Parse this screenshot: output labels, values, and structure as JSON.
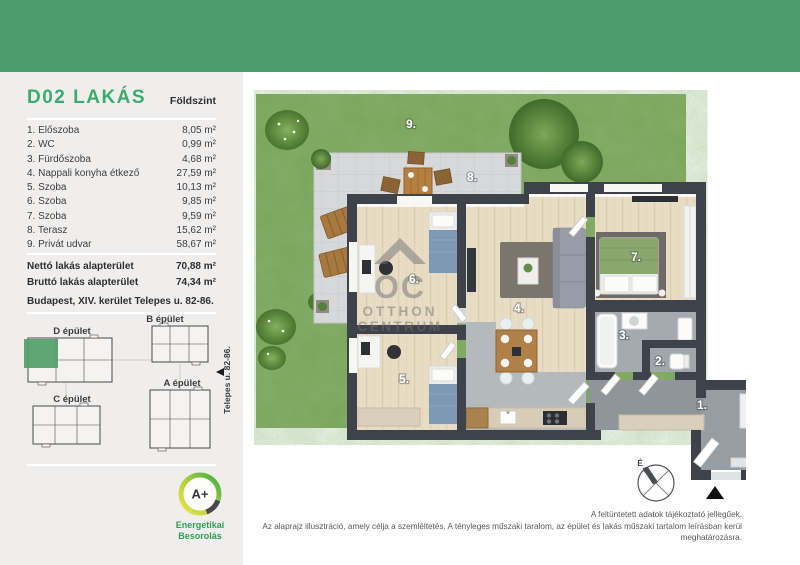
{
  "colors": {
    "header_green": "#4d9c6d",
    "accent_green": "#3cab6e",
    "site_highlight_green": "#53a06a",
    "energy_caption_green": "#2f9e52",
    "wall_dark": "#3e424a"
  },
  "sidebar": {
    "title": "D02 LAKÁS",
    "floor_label": "Földszint",
    "rooms": [
      {
        "no": "1.",
        "name": "Előszoba",
        "area": "8,05 m²"
      },
      {
        "no": "2.",
        "name": "WC",
        "area": "0,99 m²"
      },
      {
        "no": "3.",
        "name": "Fürdőszoba",
        "area": "4,68 m²"
      },
      {
        "no": "4.",
        "name": "Nappali konyha étkező",
        "area": "27,59 m²"
      },
      {
        "no": "5.",
        "name": "Szoba",
        "area": "10,13 m²"
      },
      {
        "no": "6.",
        "name": "Szoba",
        "area": "9,85 m²"
      },
      {
        "no": "7.",
        "name": "Szoba",
        "area": "9,59 m²"
      },
      {
        "no": "8.",
        "name": "Terasz",
        "area": "15,62 m²"
      },
      {
        "no": "9.",
        "name": "Privát udvar",
        "area": "58,67 m²"
      }
    ],
    "totals": [
      {
        "label": "Nettó lakás alapterület",
        "value": "70,88 m²"
      },
      {
        "label": "Bruttó lakás alapterület",
        "value": "74,34 m²"
      }
    ],
    "address": "Budapest, XIV. kerület Telepes u. 82-86."
  },
  "site": {
    "building_b": "B épület",
    "building_d": "D épület",
    "building_a": "A épület",
    "building_c": "C épület",
    "street": "Telepes u. 82-86."
  },
  "energy": {
    "rating": "A+",
    "caption1": "Energetikai",
    "caption2": "Besorolás"
  },
  "plan": {
    "labels": {
      "r1": "1.",
      "r2": "2.",
      "r3": "3.",
      "r4": "4.",
      "r5": "5.",
      "r6": "6.",
      "r7": "7.",
      "r8": "8.",
      "r9": "9."
    },
    "compass_north": "É",
    "watermark": {
      "monogram": "OC",
      "line1": "OTTHON",
      "line2": "CENTRUM"
    }
  },
  "footer": {
    "line1": "A feltüntetett adatok tájékoztató jellegűek.",
    "line2": "Az alaprajz illusztráció, amely célja a szemléltetés. A tényleges műszaki taralom, az épület és lakás műszaki tartalom leírásban kerül meghatározásra."
  }
}
